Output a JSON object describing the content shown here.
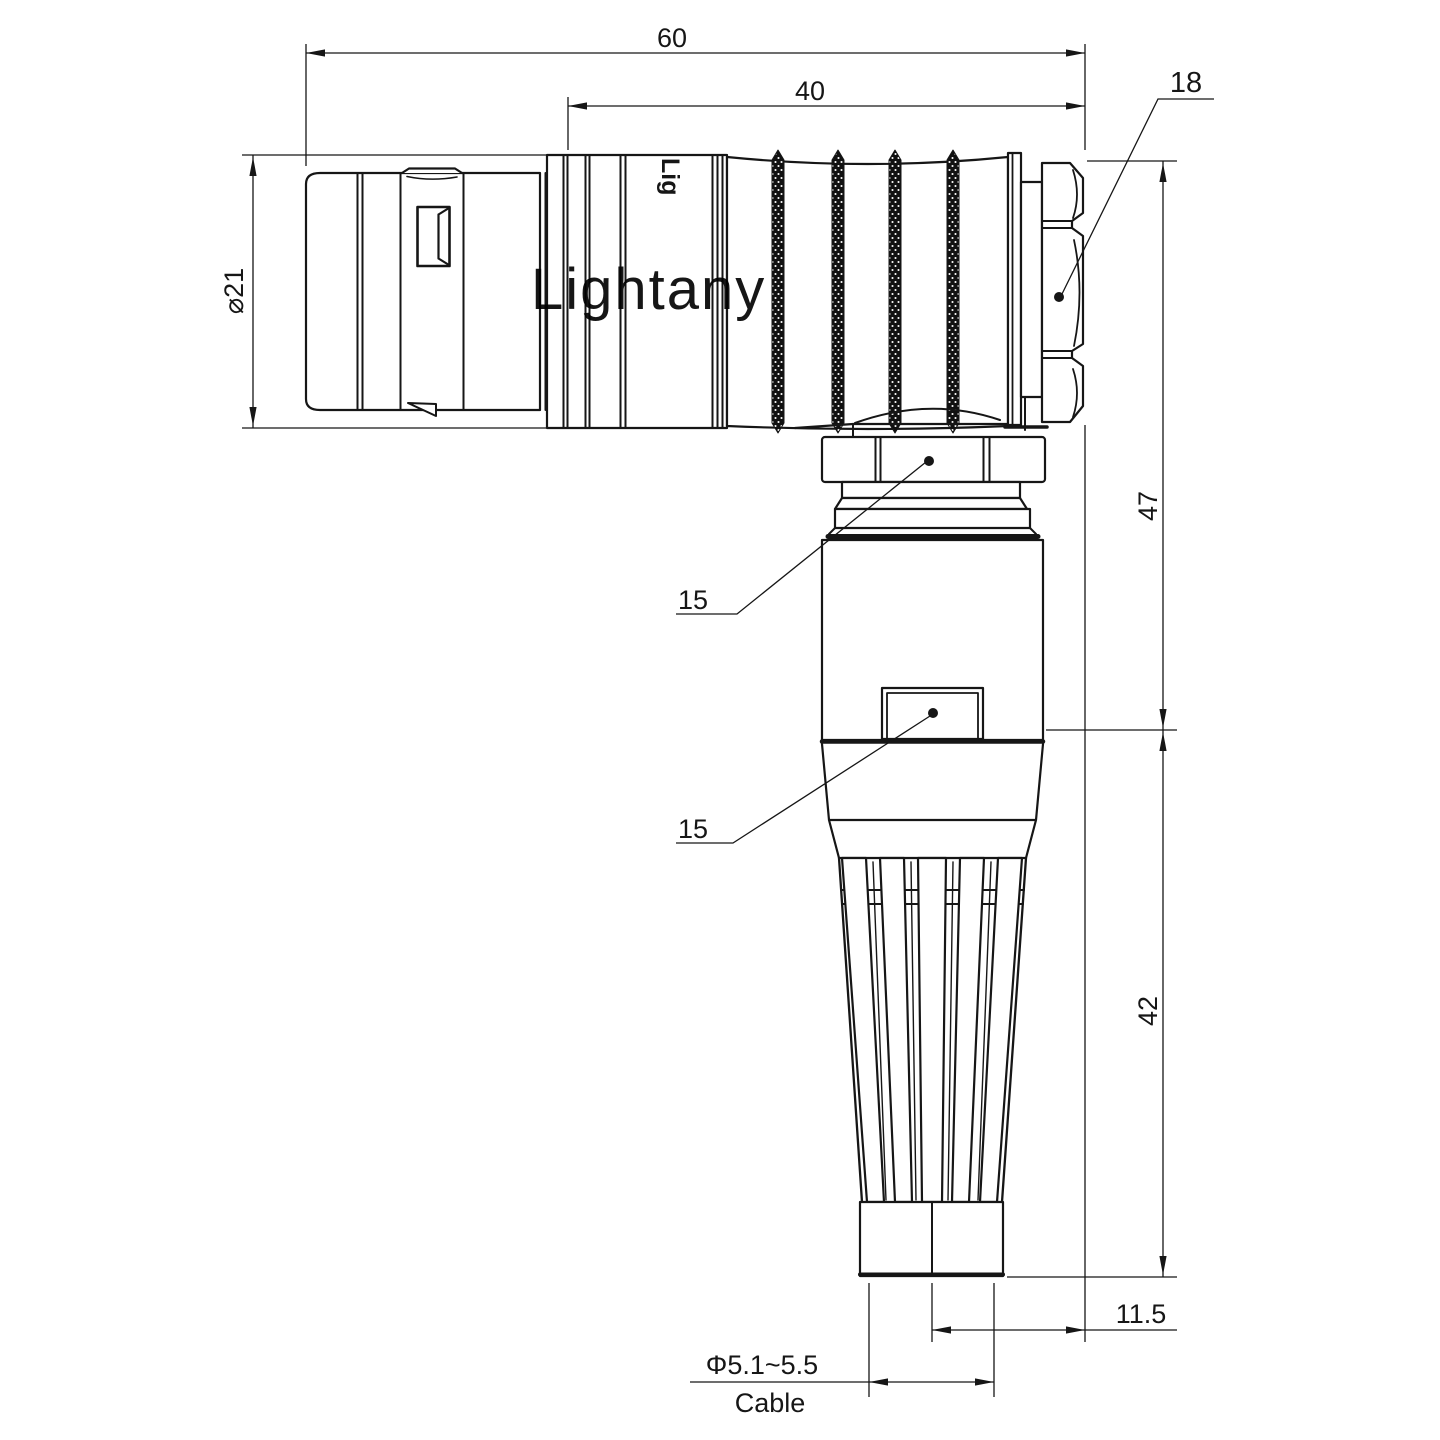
{
  "drawing": {
    "watermark": "Lightany",
    "engraving": "Lig",
    "dims": {
      "overall_length": "60",
      "body_length": "40",
      "nut_across_flats": "18",
      "plug_diameter": "⌀21",
      "upper_height": "47",
      "lower_height": "42",
      "axis_offset": "11.5",
      "cable_diameter": "Φ5.1~5.5",
      "cable_label": "Cable",
      "backnut_flats": "15",
      "tab_width": "15"
    },
    "colors": {
      "line": "#161616",
      "watermark": "#f2b6b6"
    }
  }
}
